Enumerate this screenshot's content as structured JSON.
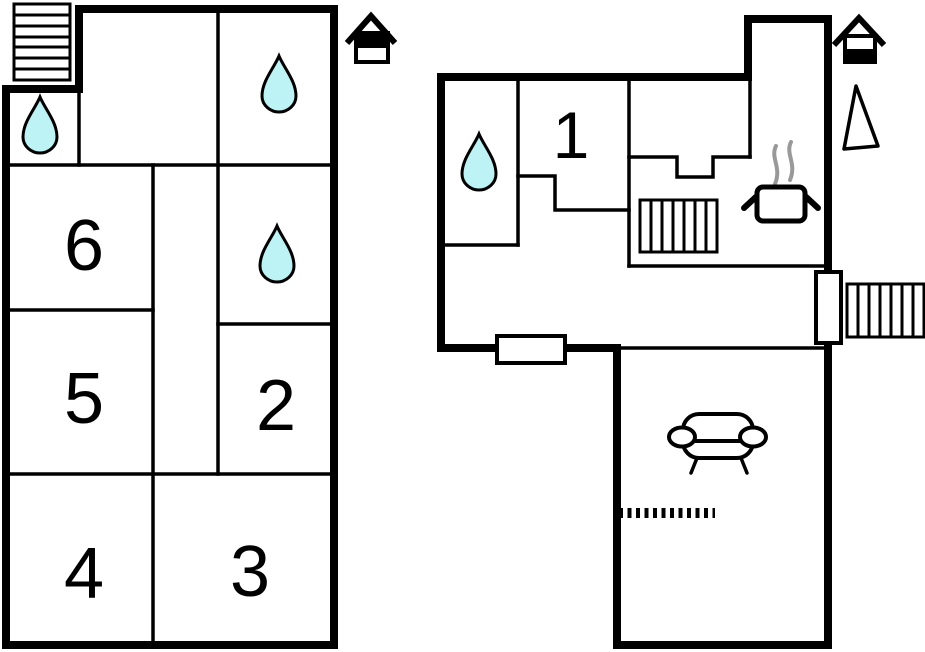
{
  "colors": {
    "background": "#ffffff",
    "wall": "#000000",
    "water_drop": "#bdf3f5",
    "steam": "#999999"
  },
  "plans": {
    "upper": {
      "name": "upper floor plan",
      "rooms": {
        "room2": "2",
        "room3": "3",
        "room4": "4",
        "room5": "5",
        "room6": "6"
      },
      "features": [
        "exterior-staircase",
        "water-drop",
        "water-drop",
        "water-drop",
        "entrance-house-icon"
      ]
    },
    "ground": {
      "name": "ground floor plan",
      "rooms": {
        "room1": "1"
      },
      "features": [
        "water-drop",
        "indoor-staircase",
        "outdoor-staircase",
        "stove",
        "window",
        "door",
        "sofa",
        "step-dashed-line",
        "entrance-house-icon",
        "north-arrow"
      ]
    }
  }
}
